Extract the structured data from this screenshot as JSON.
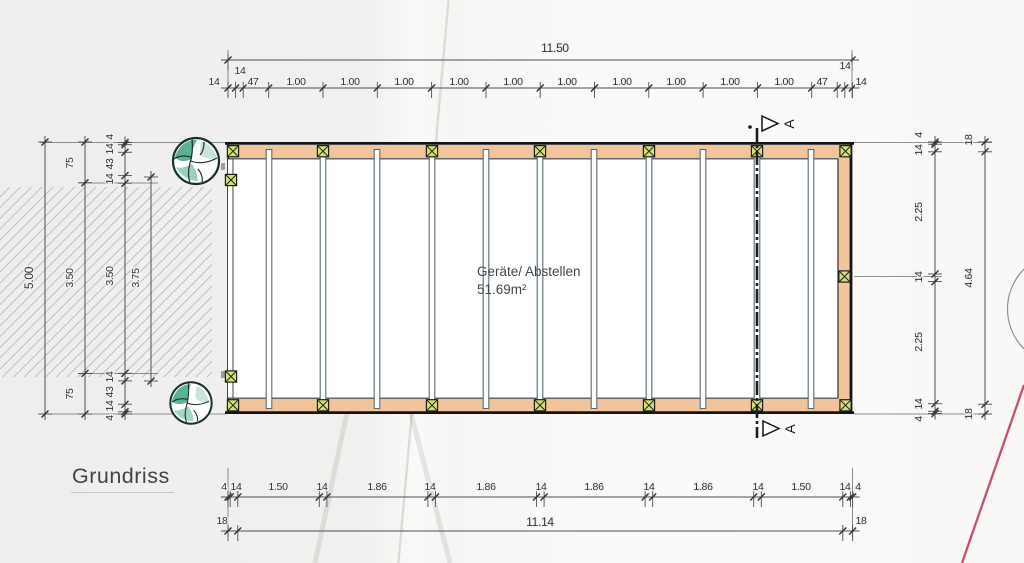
{
  "labels": {
    "drawing_title": "Grundriss",
    "section": "A"
  },
  "room": {
    "name": "Geräte/ Abstellen",
    "area": "51.69m²"
  },
  "dims": {
    "top_total": "11.50",
    "top_end_upper": [
      "14",
      "14"
    ],
    "top_chain": [
      "14",
      "47",
      "1.00",
      "1.00",
      "1.00",
      "1.00",
      "1.00",
      "1.00",
      "1.00",
      "1.00",
      "1.00",
      "1.00",
      "47",
      "14"
    ],
    "bottom_chain": [
      "4",
      "14",
      "1.50",
      "14",
      "1.86",
      "14",
      "1.86",
      "14",
      "1.86",
      "14",
      "1.86",
      "14",
      "1.50",
      "14",
      "4"
    ],
    "bottom_outer": [
      "18",
      "11.14",
      "18"
    ],
    "left_total": "5.00",
    "left_mid": [
      "75",
      "3.50",
      "75"
    ],
    "left_detail": [
      "4",
      "14",
      "43",
      "14",
      "3.50",
      "14",
      "43",
      "14",
      "4"
    ],
    "left_inner": "3.75",
    "right_detail": [
      "4",
      "14",
      "2.25",
      "14",
      "2.25",
      "14",
      "4"
    ],
    "right_outer": [
      "18",
      "4.64",
      "18"
    ]
  },
  "colors": {
    "wall": "#f2c49c",
    "post": "#d3e06e",
    "tree": "#49a98b",
    "hatch": "#bcc1cb",
    "redline": "#c94b6e"
  }
}
